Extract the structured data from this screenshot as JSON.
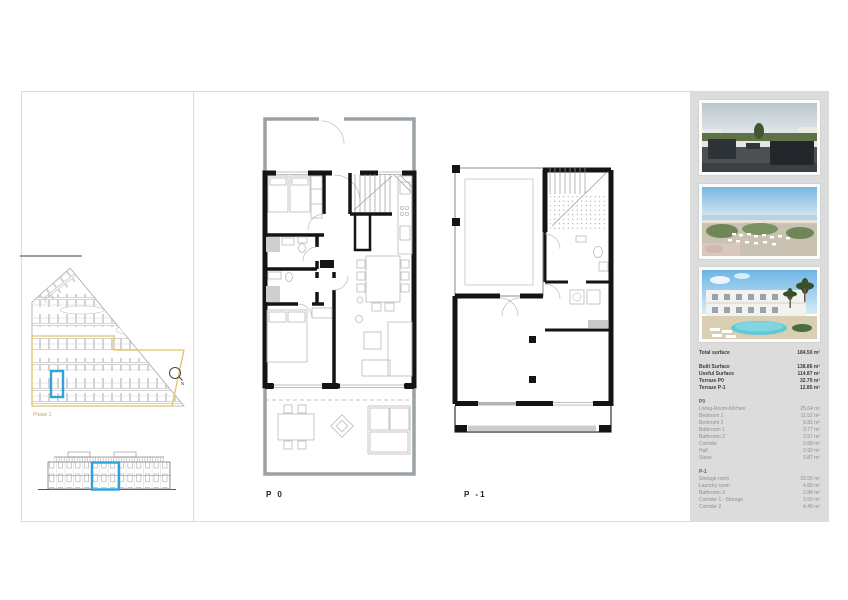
{
  "page": {
    "background": "#ffffff",
    "accent_blue": "#2ea3dc",
    "phase_yellow": "#e2c368",
    "panel_gray": "#dcdcdc"
  },
  "site": {
    "phase_label": "Phase 1",
    "compass_n": "N"
  },
  "plans": [
    {
      "label": "P 0"
    },
    {
      "label": "P -1"
    }
  ],
  "panel": {
    "photos": [
      {
        "name": "rooftop-terrace-photo"
      },
      {
        "name": "aerial-coastline-photo"
      },
      {
        "name": "residential-pool-photo"
      }
    ],
    "surfaces": {
      "total": {
        "label": "Total surface",
        "value": "184.50 m²"
      },
      "summary": [
        {
          "label": "Built Surface",
          "value": "138.86 m²"
        },
        {
          "label": "Useful Surface",
          "value": "114.87 m²"
        },
        {
          "label": "Terraze P0",
          "value": "32.79 m²"
        },
        {
          "label": "Terraze P-1",
          "value": "12.85 m²"
        }
      ],
      "sections": [
        {
          "title": "P0",
          "rooms": [
            {
              "label": "Living-Room-Kitchen",
              "value": "25.64 m²"
            },
            {
              "label": "Bedroom 1",
              "value": "11.52 m²"
            },
            {
              "label": "Bedroom 2",
              "value": "9.81 m²"
            },
            {
              "label": "Bathroom 1",
              "value": "3.77 m²"
            },
            {
              "label": "Bathroom 2",
              "value": "3.57 m²"
            },
            {
              "label": "Corridor",
              "value": "2.68 m²"
            },
            {
              "label": "Hall",
              "value": "3.92 m²"
            },
            {
              "label": "Stairs",
              "value": "3.87 m²"
            }
          ]
        },
        {
          "title": "P-1",
          "rooms": [
            {
              "label": "Storage room",
              "value": "33.55 m²"
            },
            {
              "label": "Laundry room",
              "value": "4.80 m²"
            },
            {
              "label": "Bathroom 3",
              "value": "3.84 m²"
            },
            {
              "label": "Corridor 1 - Storage",
              "value": "3.50 m²"
            },
            {
              "label": "Corridor 2",
              "value": "4.40 m²"
            }
          ]
        }
      ]
    }
  }
}
